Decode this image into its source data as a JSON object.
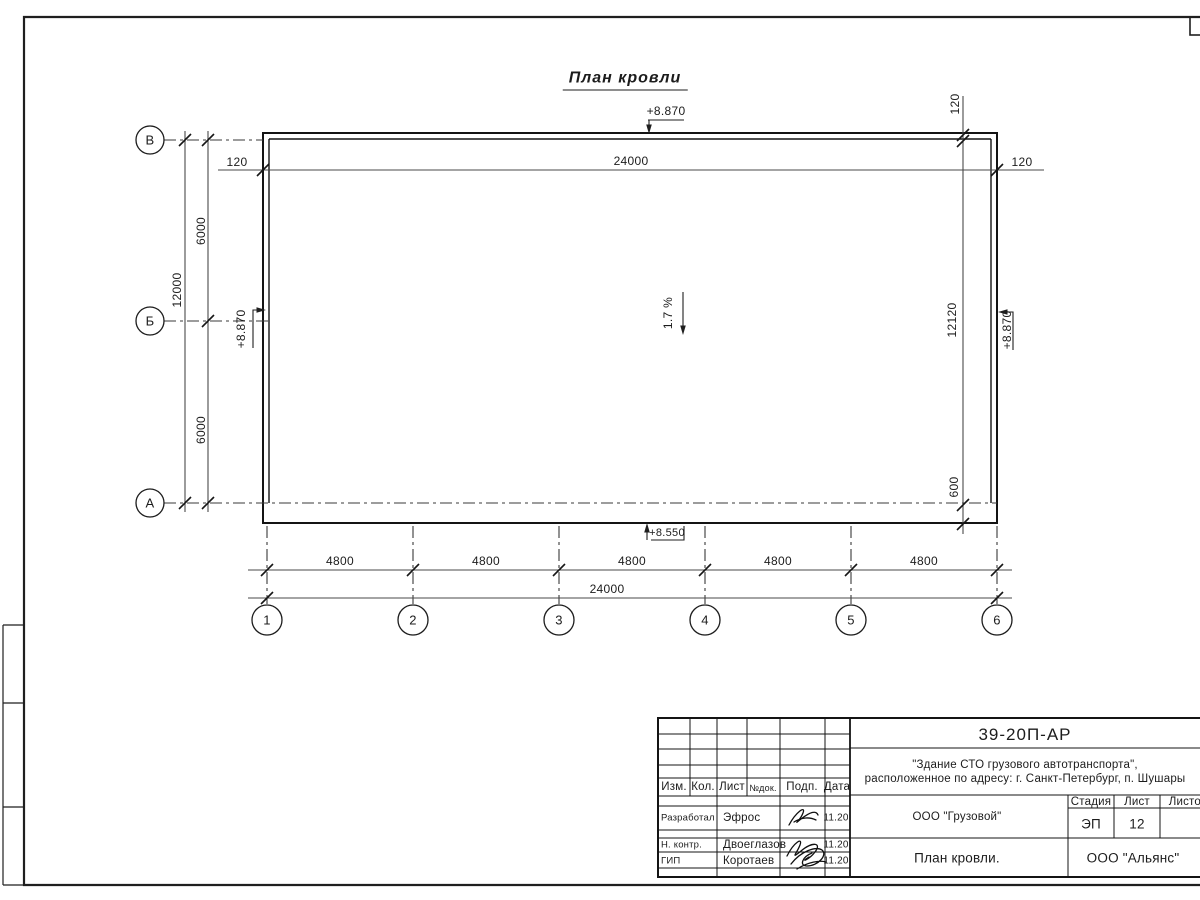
{
  "drawing": {
    "title": "План кровли",
    "slope_label": "1.7 %",
    "elevations": {
      "top": "+8.870",
      "left": "+8.870",
      "right": "+8.870",
      "bottom": "+8.550"
    },
    "dimensions": {
      "top_total": "24000",
      "offset_top_left": "120",
      "offset_top_right": "120",
      "offset_top_right_vertical": "120",
      "left_total": "12000",
      "left_bay_upper": "6000",
      "left_bay_lower": "6000",
      "right_total": "12120",
      "right_overhang": "600",
      "bottom_bays": [
        "4800",
        "4800",
        "4800",
        "4800",
        "4800"
      ],
      "bottom_total": "24000"
    },
    "axes_horizontal": [
      "В",
      "Б",
      "А"
    ],
    "axes_vertical": [
      "1",
      "2",
      "3",
      "4",
      "5",
      "6"
    ]
  },
  "title_block": {
    "doc_code": "39-20П-АР",
    "object_line1": "\"Здание СТО грузового автотранспорта\",",
    "object_line2": "расположенное по адресу: г. Санкт-Петербург, п. Шушары",
    "columns": [
      "Изм.",
      "Кол.",
      "Лист",
      "№док.",
      "Подп.",
      "Дата"
    ],
    "rows": [
      {
        "role": "Разработал",
        "name": "Эфрос",
        "date": "11.20"
      },
      {
        "role": "Н. контр.",
        "name": "Двоеглазов",
        "date": "11.20"
      },
      {
        "role": "ГИП",
        "name": "Коротаев",
        "date": "11.20"
      }
    ],
    "client": "ООО \"Грузовой\"",
    "stage_label": "Стадия",
    "sheet_label": "Лист",
    "sheets_label": "Листов",
    "stage": "ЭП",
    "sheet": "12",
    "sheet_title": "План кровли.",
    "company": "ООО \"Альянс\""
  }
}
